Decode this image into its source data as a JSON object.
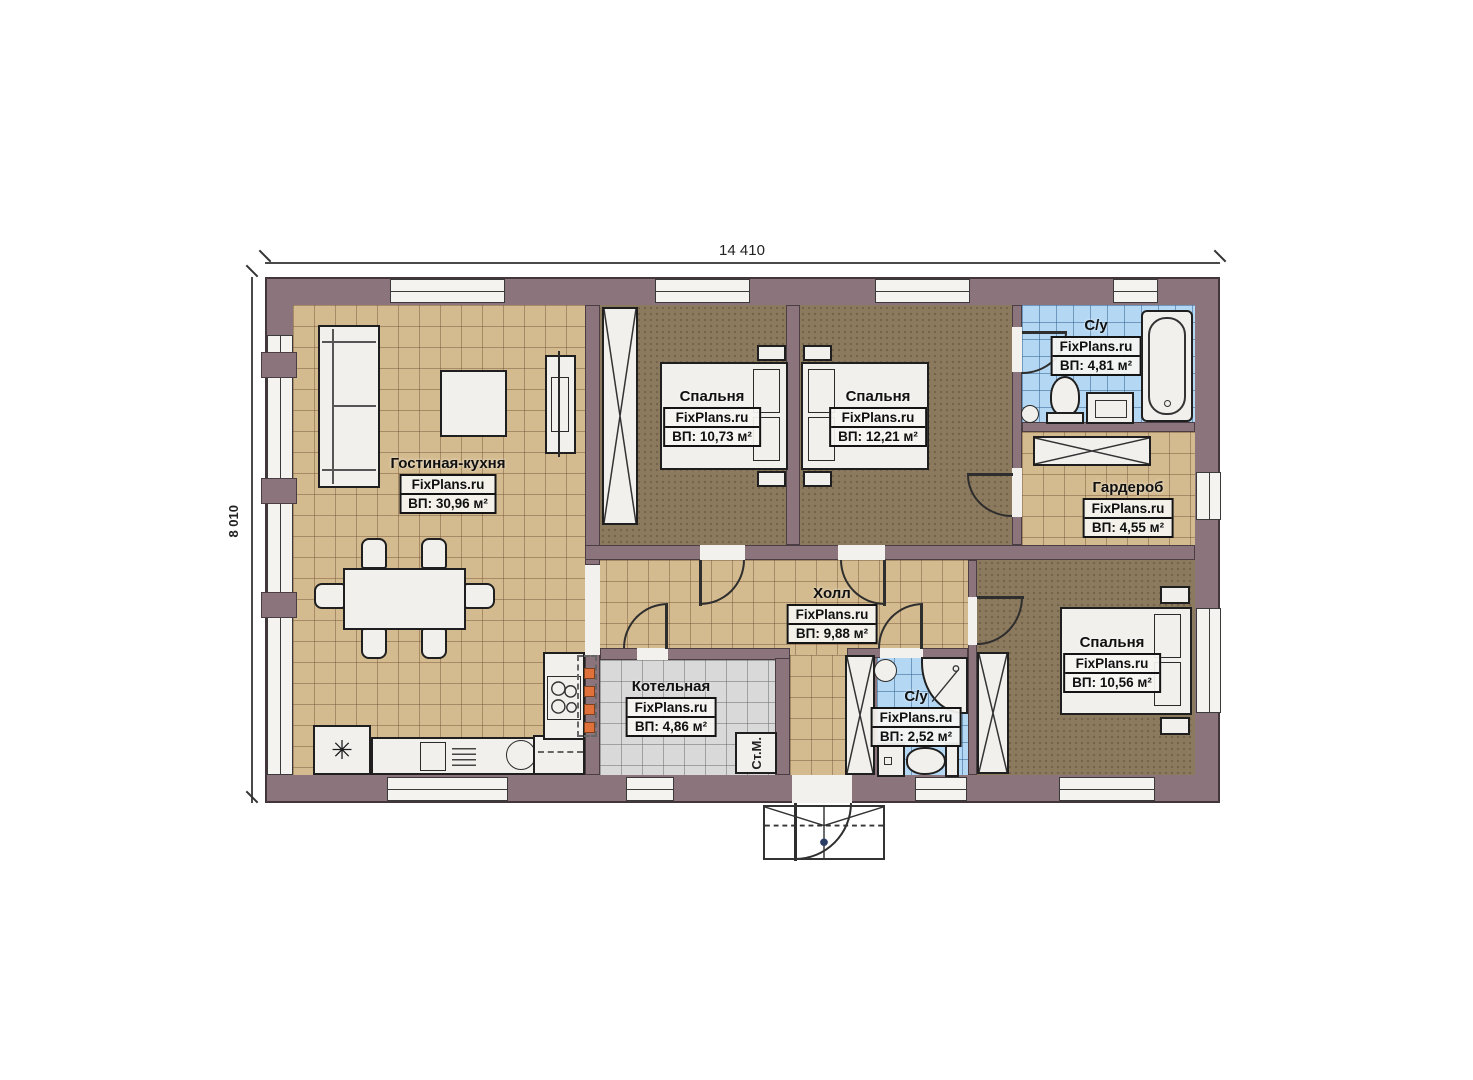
{
  "plan": {
    "dimensions": {
      "width": "14 410",
      "height": "8 010"
    },
    "watermark": "FixPlans.ru",
    "rooms": [
      {
        "name": "Гостиная-кухня",
        "watermark": "FixPlans.ru",
        "area": "ВП: 30,96 м²"
      },
      {
        "name": "Спальня",
        "watermark": "FixPlans.ru",
        "area": "ВП: 10,73 м²"
      },
      {
        "name": "Спальня",
        "watermark": "FixPlans.ru",
        "area": "ВП: 12,21 м²"
      },
      {
        "name": "С/у",
        "watermark": "FixPlans.ru",
        "area": "ВП: 4,81 м²"
      },
      {
        "name": "Гардероб",
        "watermark": "FixPlans.ru",
        "area": "ВП: 4,55 м²"
      },
      {
        "name": "Холл",
        "watermark": "FixPlans.ru",
        "area": "ВП: 9,88 м²"
      },
      {
        "name": "Котельная",
        "watermark": "FixPlans.ru",
        "area": "ВП: 4,86 м²"
      },
      {
        "name": "С/у",
        "watermark": "FixPlans.ru",
        "area": "ВП: 2,52 м²"
      },
      {
        "name": "Спальня",
        "watermark": "FixPlans.ru",
        "area": "ВП: 10,56 м²"
      }
    ],
    "labels": {
      "washing_machine": "Ст.М."
    },
    "symbols": {
      "fridge_snowflake": "✳"
    },
    "colors": {
      "wall": "#8b747b",
      "floor_tile_tan": "#d4bb8f",
      "floor_tile_blue": "#b4d7f3",
      "floor_tile_gray": "#d9d9d9",
      "carpet_brown": "#8c7a5e",
      "accent_orange": "#e0713a"
    }
  }
}
